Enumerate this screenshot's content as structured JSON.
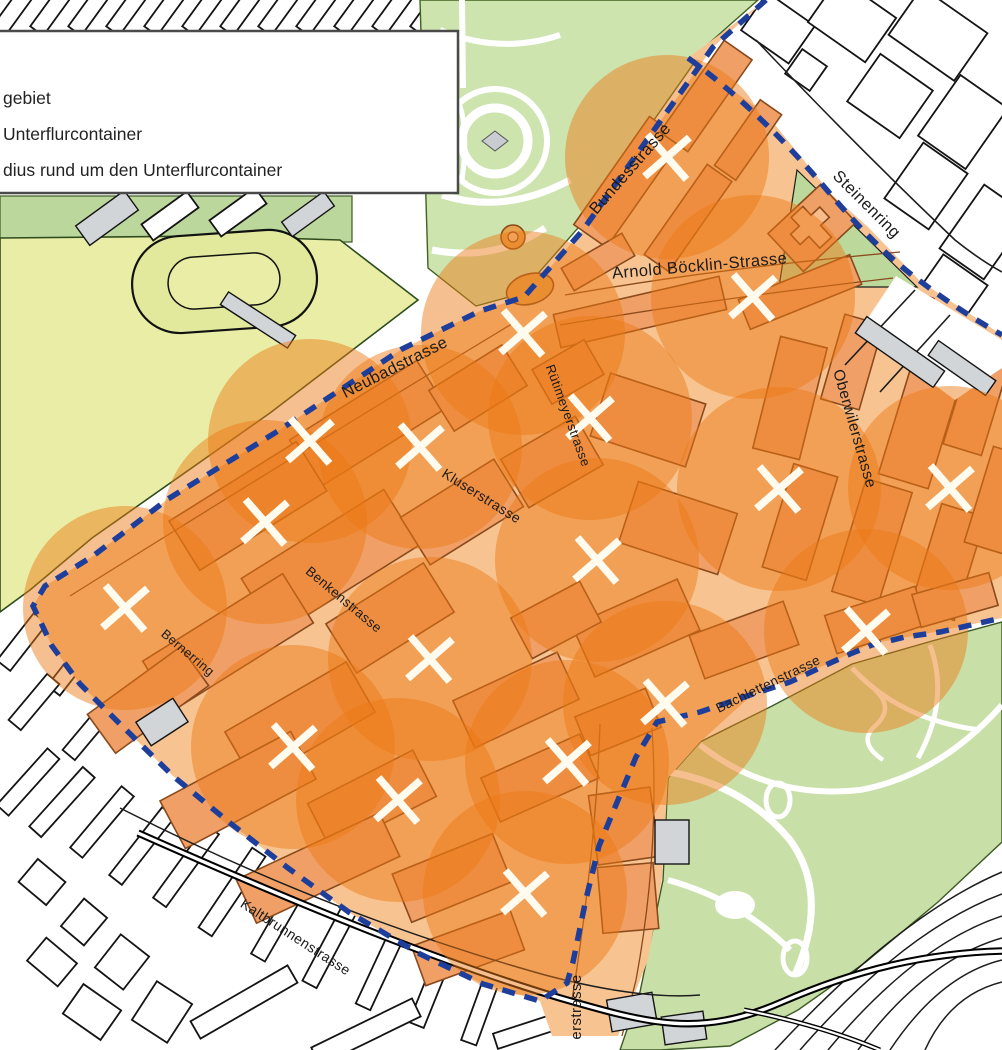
{
  "legend": {
    "items": [
      {
        "label": "gebiet"
      },
      {
        "label": "Unterflurcontainer"
      },
      {
        "label": "dius rund um den Unterflurcontainer"
      }
    ]
  },
  "map": {
    "street_labels": [
      {
        "name": "Bundesstrasse",
        "x": 634,
        "y": 172,
        "rot": -49,
        "size": 16.5
      },
      {
        "name": "Steinenring",
        "x": 863,
        "y": 208,
        "rot": 45,
        "size": 16.5
      },
      {
        "name": "Arnold Böcklin-Strasse",
        "x": 700,
        "y": 271,
        "rot": -5,
        "size": 16.5
      },
      {
        "name": "Neubadstrasse",
        "x": 397,
        "y": 372,
        "rot": -27,
        "size": 16.5
      },
      {
        "name": "Rütimeyerstrasse",
        "x": 564,
        "y": 417,
        "rot": 70,
        "size": 13
      },
      {
        "name": "Kluserstrasse",
        "x": 479,
        "y": 500,
        "rot": 32,
        "size": 14
      },
      {
        "name": "Benkenstrasse",
        "x": 341,
        "y": 603,
        "rot": 40,
        "size": 13.5
      },
      {
        "name": "Bernerring",
        "x": 185,
        "y": 656,
        "rot": 40,
        "size": 13
      },
      {
        "name": "Oberwilerstrasse",
        "x": 850,
        "y": 430,
        "rot": 74,
        "size": 15.5
      },
      {
        "name": "Bachlettenstrasse",
        "x": 770,
        "y": 688,
        "rot": -26,
        "size": 13.5
      },
      {
        "name": "Kaltbrunnenstrasse",
        "x": 293,
        "y": 941,
        "rot": 33,
        "size": 14
      },
      {
        "name": "erstrasse",
        "x": 581,
        "y": 1007,
        "rot": -90,
        "size": 15
      }
    ],
    "containers": [
      [
        667,
        157
      ],
      [
        523,
        333
      ],
      [
        753,
        297
      ],
      [
        590,
        418
      ],
      [
        420,
        447
      ],
      [
        310,
        441
      ],
      [
        265,
        522
      ],
      [
        125,
        608
      ],
      [
        430,
        659
      ],
      [
        597,
        560
      ],
      [
        779,
        489
      ],
      [
        950,
        488
      ],
      [
        866,
        631
      ],
      [
        665,
        703
      ],
      [
        293,
        747
      ],
      [
        398,
        800
      ],
      [
        567,
        762
      ],
      [
        525,
        893
      ]
    ],
    "radius_circle": {
      "radius": 102,
      "color": "#ec7a15",
      "opacity": 0.48
    },
    "container_mark": {
      "color": "#fffbee",
      "arm": 21,
      "stroke_width": 7.5
    },
    "boundary": {
      "color": "#1e3e9c",
      "style": "dashed"
    },
    "colors": {
      "park": "#cde4af",
      "park_se": "#c8e0a8",
      "field": "#e9eda5",
      "pilot_base": "#f7c391",
      "building": "#f0a066",
      "building_outline": "#8a4a1c",
      "outside_outline": "#141414"
    }
  }
}
